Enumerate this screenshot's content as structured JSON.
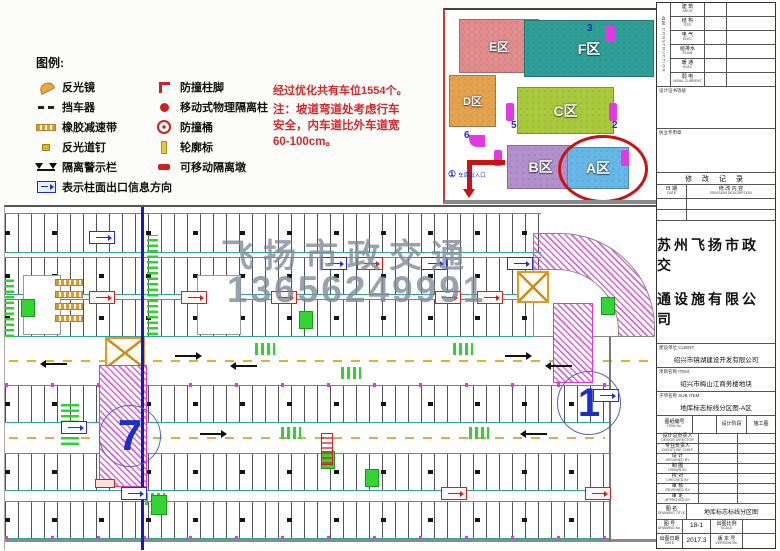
{
  "colors": {
    "note_red": "#cf2b2b",
    "teal_line": "#2fa39b",
    "magenta_ramp": "#d63ad6",
    "blue_mark": "#1b2fc4",
    "green_mark": "#2ed32e",
    "orange_mark": "#e09a28",
    "watermark_gray": "#7d8896",
    "zone_e": "#e08c8c",
    "zone_f": "#2f9e96",
    "zone_d": "#e2a24e",
    "zone_c": "#a8c93c",
    "zone_b": "#b290cc",
    "zone_a": "#66b6e6"
  },
  "legend": {
    "title": "图例:",
    "col1": [
      {
        "icon": "mirror-icon",
        "label": "反光镜"
      },
      {
        "icon": "wheel-stop-icon",
        "label": "挡车器"
      },
      {
        "icon": "speed-bump-icon",
        "label": "橡胶减速带"
      },
      {
        "icon": "road-stud-icon",
        "label": "反光道钉"
      },
      {
        "icon": "warning-fence-icon",
        "label": "隔离警示栏"
      }
    ],
    "col2": [
      {
        "icon": "bollard-base-icon",
        "label": "防撞柱脚"
      },
      {
        "icon": "barrier-post-icon",
        "label": "移动式物理隔离柱"
      },
      {
        "icon": "crash-barrel-icon",
        "label": "防撞桶"
      },
      {
        "icon": "delineator-icon",
        "label": "轮廓标"
      },
      {
        "icon": "barrier-block-icon",
        "label": "可移动隔离墩"
      }
    ],
    "bottom": {
      "icon": "exit-info-direction-icon",
      "label": "表示柱面出口信息方向"
    }
  },
  "note": {
    "line1": "经过优化共有车位1554个。",
    "line2": "注：坡道弯道处考虑行车",
    "line3": "安全，内车道比外车道宽",
    "line4": "60-100cm。"
  },
  "overview": {
    "zones": {
      "e": "E区",
      "f": "F区",
      "d": "D区",
      "c": "C区",
      "b": "B区",
      "a": "A区"
    },
    "markers": {
      "n3": "3",
      "n5": "5",
      "n2": "2",
      "n6": "6"
    },
    "entrance": {
      "num": "①",
      "label": "车库出入口"
    }
  },
  "plan": {
    "watermark_line1": "飞扬市政交通",
    "watermark_line2": "13656249991",
    "ramp_left_num": "7",
    "ramp_right_num": "1"
  },
  "titleblock": {
    "signoff_vertical": "会签 CONSTRUCTION",
    "signoff_rows": [
      {
        "cn": "建 筑",
        "en": "ARCH"
      },
      {
        "cn": "结 构",
        "en": "STR"
      },
      {
        "cn": "电 气",
        "en": "ELEC"
      },
      {
        "cn": "给排水",
        "en": "PLUM"
      },
      {
        "cn": "暖 通",
        "en": "HVAC"
      },
      {
        "cn": "弱 电",
        "en": "WEAK CURRENT"
      }
    ],
    "cert_label": "设计证书等级",
    "seal_label": "执业专用章",
    "revision_title": "修 改 记 录",
    "rev_date_cn": "日 期",
    "rev_date_en": "DATE",
    "rev_desc_cn": "修 改 内 容",
    "rev_desc_en": "REVISION DESCRIPTION",
    "company_line1": "苏州飞扬市政交",
    "company_line2": "通设施有限公司",
    "client_label": "建设单位 CLIENT",
    "client_value": "绍兴市镜湖建设开发有限公司",
    "project_label": "项目名称 ITEM",
    "project_value": "绍兴市梅山江商务楼地块",
    "subitem_label": "子项名称 SUB ITEM",
    "subitem_value": "地库标志标线分区图-A区",
    "sheet_no_label_cn": "图纸编号",
    "sheet_no_label_en": "ITEM No.",
    "stage_label": "设计阶段",
    "stage_value": "施工图",
    "staff_rows": [
      {
        "cn": "设计总负责人",
        "en": "DESIGN DIRECTOR"
      },
      {
        "cn": "专业负责人",
        "en": "DISCIPLINE CHIEF"
      },
      {
        "cn": "设 计",
        "en": "DESIGNED BY"
      },
      {
        "cn": "制 图",
        "en": "DRAWN BY"
      },
      {
        "cn": "校 对",
        "en": "CHECKED BY"
      },
      {
        "cn": "审 核",
        "en": "REVIEWED BY"
      },
      {
        "cn": "审 定",
        "en": "APPROVED BY"
      }
    ],
    "title_label_cn": "图 名",
    "title_label_en": "DRAWING TITLE",
    "title_value": "地库标志标线分区图",
    "no_label_cn": "图 号",
    "no_label_en": "DRAWING No.",
    "no_value": "18-1",
    "scale_label_cn": "出图比例",
    "scale_label_en": "SCALE",
    "date_label_cn": "出图日期",
    "date_label_en": "DATE",
    "date_value": "2017.3",
    "ver_label_cn": "版 本 号",
    "ver_label_en": "VERSION No."
  }
}
